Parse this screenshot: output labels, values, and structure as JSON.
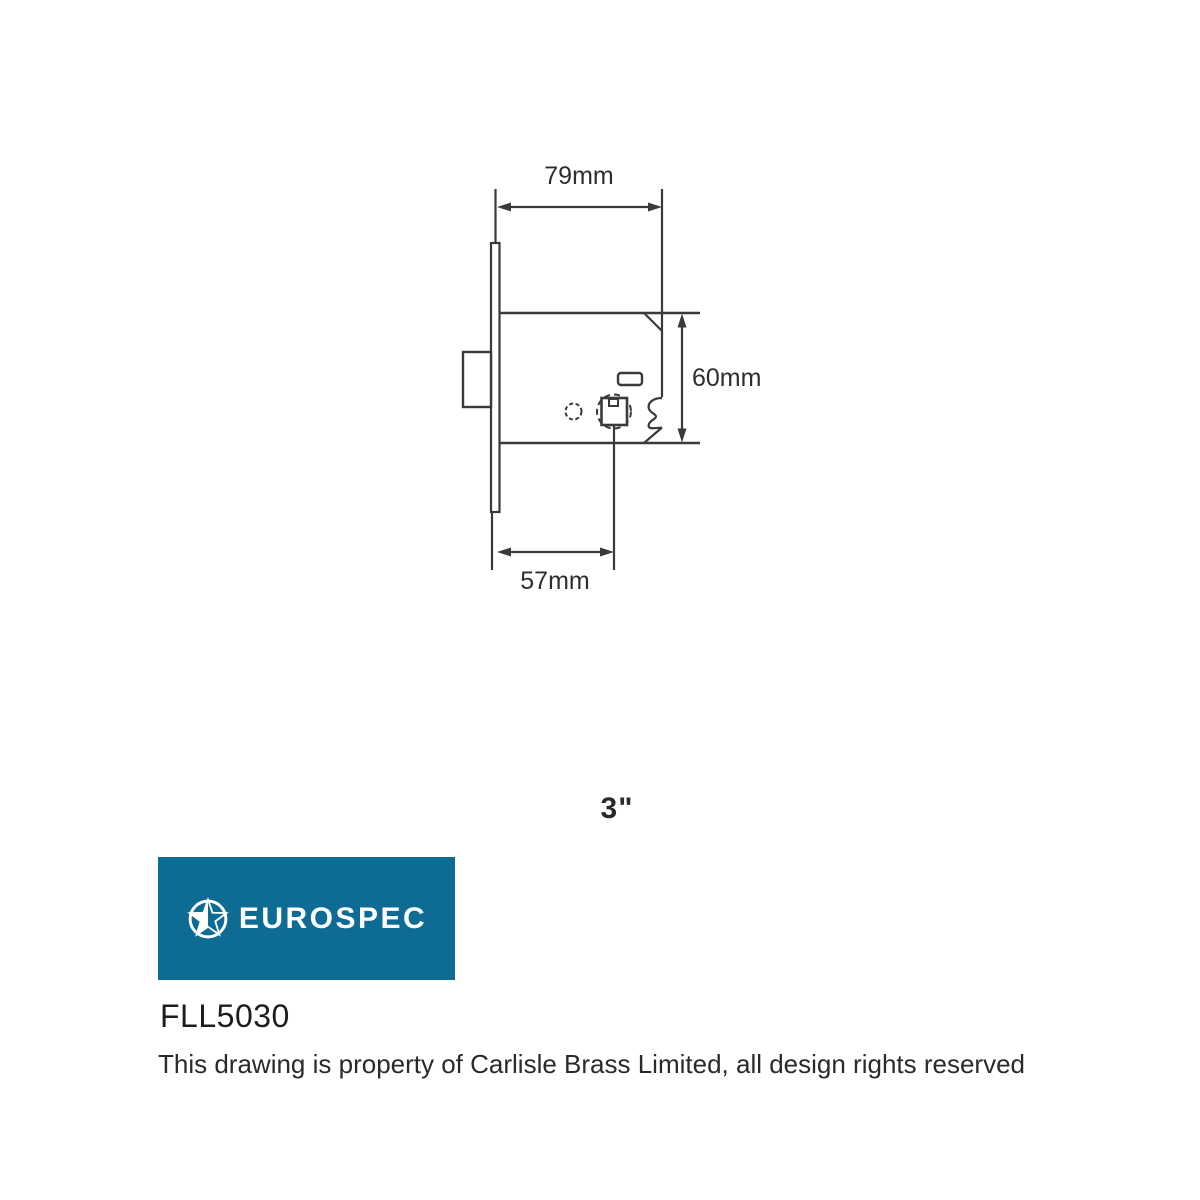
{
  "drawing": {
    "type": "technical-drawing",
    "subject": "mortice latch, side elevation",
    "dimensions": {
      "width_label": "79mm",
      "height_label": "60mm",
      "backset_label": "57mm"
    },
    "size_label": "3\""
  },
  "logo": {
    "brand": "EUROSPEC",
    "icon": "star-circle-icon",
    "bg_color": "#0E6B94",
    "text_color": "#FFFFFF"
  },
  "product_code": "FLL5030",
  "copyright": "This drawing is property of Carlisle Brass Limited, all design rights reserved",
  "colors": {
    "line": "#3A3A3A",
    "text": "#2A2A2A",
    "background": "#FFFFFF"
  }
}
